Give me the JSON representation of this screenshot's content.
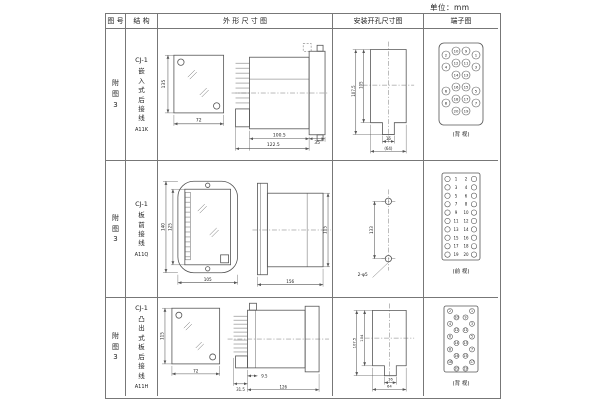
{
  "unit_label": "单位：mm",
  "colors": {
    "ink": "#555",
    "text": "#222",
    "border": "#777"
  },
  "table": {
    "headers": {
      "fig_no": "图 号",
      "structure": "结 构",
      "outline": "外 形 尺 寸 图",
      "install": "安装开孔尺寸图",
      "terminal": "端子图"
    },
    "rows": [
      {
        "fig_no": "附图3",
        "model": "CJ-1",
        "desc": "嵌入式后接线",
        "code": "A11K",
        "outline": {
          "h": "135",
          "w": "72",
          "d1": "100.5",
          "d2": "122.5",
          "d3": "35"
        },
        "install": {
          "h1": "107.5",
          "h2": "105",
          "w1": "16",
          "w2": "(64)"
        },
        "terminal": {
          "type": "grid4",
          "view": "(背 视)",
          "rows": [
            [
              "2",
              "10",
              "9",
              "1"
            ],
            [
              "4",
              "12",
              "11",
              "3"
            ],
            [
              "",
              "14",
              "13",
              ""
            ],
            [
              "6",
              "16",
              "15",
              "5"
            ],
            [
              "8",
              "18",
              "17",
              "7"
            ],
            [
              "",
              "20",
              "19",
              ""
            ]
          ]
        }
      },
      {
        "fig_no": "附图3",
        "model": "CJ-1",
        "desc": "板前接线",
        "code": "A11Q",
        "outline": {
          "h": "140",
          "h2": "125",
          "w": "105",
          "d1": "156",
          "d2": "115"
        },
        "install": {
          "h1": "133",
          "hole": "2-φ5"
        },
        "terminal": {
          "type": "strip2",
          "view": "(前 视)",
          "rows": [
            [
              "1",
              "2"
            ],
            [
              "3",
              "4"
            ],
            [
              "5",
              "6"
            ],
            [
              "7",
              "8"
            ],
            [
              "9",
              "10"
            ],
            [
              "11",
              "12"
            ],
            [
              "13",
              "14"
            ],
            [
              "15",
              "16"
            ],
            [
              "17",
              "18"
            ],
            [
              "19",
              "20"
            ]
          ]
        }
      },
      {
        "fig_no": "附图3",
        "model": "CJ-1",
        "desc": "凸出式板后接线",
        "code": "A11H",
        "outline": {
          "h": "115",
          "w": "72",
          "d1": "9.5",
          "d2": "31.5",
          "d3": "126"
        },
        "install": {
          "h1": "107.5",
          "h2": "104",
          "w1": "16",
          "w2": "64"
        },
        "terminal": {
          "type": "zigzag",
          "view": "(背 视)",
          "rows": [
            [
              "2",
              "1"
            ],
            [
              "10",
              "9"
            ],
            [
              "4",
              "3"
            ],
            [
              "12",
              "11"
            ],
            [
              "6",
              "5"
            ],
            [
              "14",
              "13"
            ],
            [
              "8",
              "7"
            ],
            [
              "16",
              "15"
            ],
            [
              "18",
              "17"
            ],
            [
              "20",
              "19"
            ]
          ]
        }
      }
    ]
  }
}
